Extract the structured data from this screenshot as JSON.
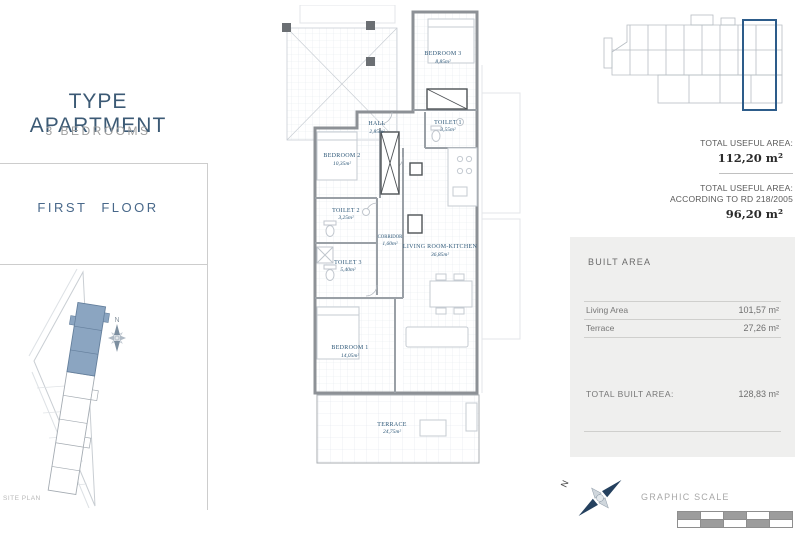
{
  "header": {
    "title": "TYPE APARTMENT",
    "subtitle": "3 BEDROOMS",
    "floor_label": "FIRST FLOOR"
  },
  "site_plan": {
    "label": "SITE PLAN",
    "north": "N"
  },
  "plan": {
    "rooms": [
      {
        "name": "BEDROOM 3",
        "area": "8,85m²"
      },
      {
        "name": "TOILET 1",
        "area": "3,55m²"
      },
      {
        "name": "HALL",
        "area": "2,85m²"
      },
      {
        "name": "BEDROOM 2",
        "area": "10,35m²"
      },
      {
        "name": "TOILET 2",
        "area": "3,25m²"
      },
      {
        "name": "CORRIDOR",
        "area": "1,60m²"
      },
      {
        "name": "TOILET 3",
        "area": "5,40m²"
      },
      {
        "name": "BEDROOM 1",
        "area": "14,05m²"
      },
      {
        "name": "LIVING ROOM-KITCHEN",
        "area": "36,85m²"
      },
      {
        "name": "TERRACE",
        "area": "24,75m²"
      }
    ]
  },
  "summary": {
    "useful_area_label": "TOTAL USEFUL AREA:",
    "useful_area_value": "112,20 m²",
    "useful_rd_label1": "TOTAL USEFUL AREA:",
    "useful_rd_label2": "ACCORDING TO RD 218/2005",
    "useful_rd_value": "96,20 m²",
    "built_area_title": "BUILT AREA",
    "built_rows": [
      {
        "label": "Living Area",
        "value": "101,57 m²"
      },
      {
        "label": "Terrace",
        "value": "27,26 m²"
      }
    ],
    "total_built_label": "TOTAL BUILT AREA:",
    "total_built_value": "128,83 m²"
  },
  "footer": {
    "graphic_scale_label": "GRAPHIC SCALE",
    "north": "N"
  },
  "colors": {
    "accent_blue": "#3c5a75",
    "room_label_blue": "#2e5878",
    "site_highlight": "#8ba5c1",
    "keyplan_highlight": "#2d5c8a",
    "wall_gray": "#8d9196",
    "box_gray": "#efefee"
  }
}
